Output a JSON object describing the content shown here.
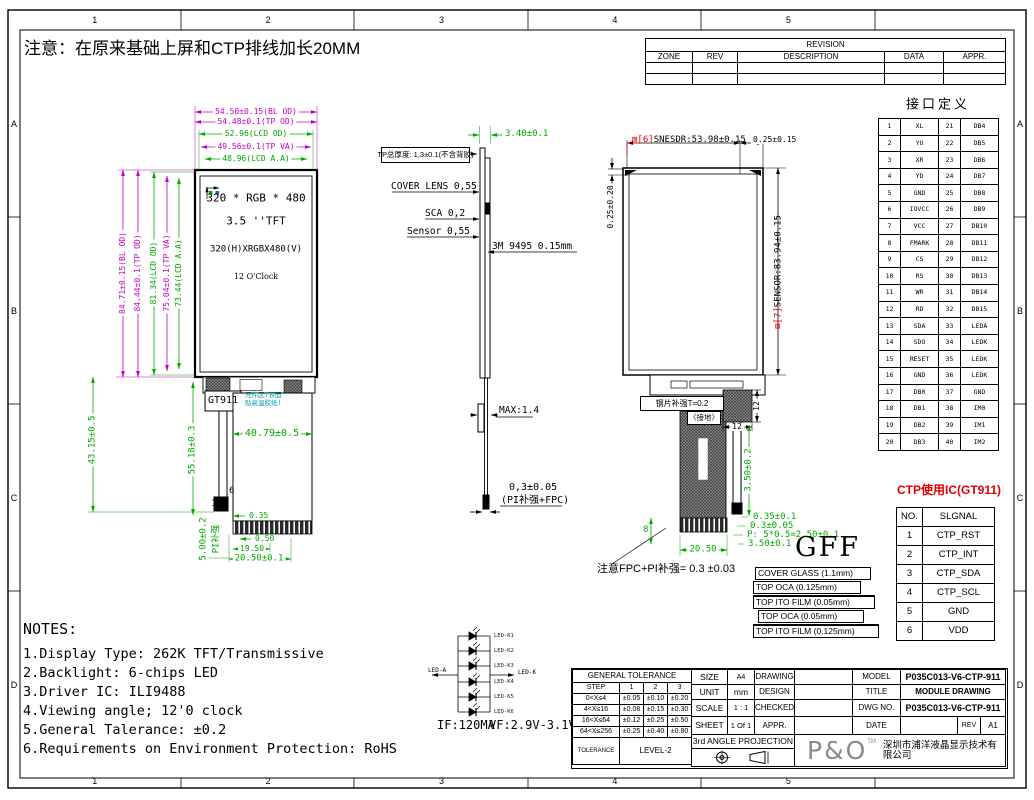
{
  "note_top": "注意：在原来基础上屏和CTP排线加长20MM",
  "border": {
    "cols": [
      "1",
      "2",
      "3",
      "4",
      "5"
    ],
    "rows": [
      "A",
      "B",
      "C",
      "D"
    ]
  },
  "revision": {
    "title": "REVISION",
    "rows": [
      [
        "ZONE",
        "REV",
        "DESCRIPTION",
        "DATA",
        "APPR."
      ],
      [
        "",
        "",
        "",
        "",
        ""
      ],
      [
        "",
        "",
        "",
        "",
        ""
      ]
    ]
  },
  "interface": {
    "title": "接口定义",
    "rows": [
      [
        "1",
        "XL",
        "21",
        "DB4"
      ],
      [
        "2",
        "YU",
        "22",
        "DB5"
      ],
      [
        "3",
        "XR",
        "23",
        "DB6"
      ],
      [
        "4",
        "YD",
        "24",
        "DB7"
      ],
      [
        "5",
        "GND",
        "25",
        "DB8"
      ],
      [
        "6",
        "IOVCC",
        "26",
        "DB9"
      ],
      [
        "7",
        "VCC",
        "27",
        "DB10"
      ],
      [
        "8",
        "FMARK",
        "28",
        "DB11"
      ],
      [
        "9",
        "CS",
        "29",
        "DB12"
      ],
      [
        "10",
        "RS",
        "30",
        "DB13"
      ],
      [
        "11",
        "WR",
        "31",
        "DB14"
      ],
      [
        "12",
        "RD",
        "32",
        "DB15"
      ],
      [
        "13",
        "SDA",
        "33",
        "LEDA"
      ],
      [
        "14",
        "SDO",
        "34",
        "LEDK"
      ],
      [
        "15",
        "RESET",
        "35",
        "LEDK"
      ],
      [
        "16",
        "GND",
        "36",
        "LEDK"
      ],
      [
        "17",
        "DB0",
        "37",
        "GND"
      ],
      [
        "18",
        "DB1",
        "38",
        "IM0"
      ],
      [
        "19",
        "DB2",
        "39",
        "IM1"
      ],
      [
        "20",
        "DB3",
        "40",
        "IM2"
      ]
    ]
  },
  "ctp": {
    "title": "CTP使用IC(GT911)",
    "rows": [
      [
        "NO.",
        "SLGNAL"
      ],
      [
        "1",
        "CTP_RST"
      ],
      [
        "2",
        "CTP_INT"
      ],
      [
        "3",
        "CTP_SDA"
      ],
      [
        "4",
        "CTP_SCL"
      ],
      [
        "5",
        "GND"
      ],
      [
        "6",
        "VDD"
      ]
    ]
  },
  "front": {
    "dims_top": [
      "54.50±0.15(BL OD)",
      "54.48±0.1(TP OD)",
      "52.96(LCD OD)",
      "49.56±0.1(TP VA)",
      "48.96(LCD A.A)"
    ],
    "dims_left": [
      "84.71±0.15(BL OD)",
      "84.44±0.1(TP OD)",
      "81.34(LCD OD)",
      "75.04±0.1(TP VA)",
      "73.44(LCD A.A)"
    ],
    "panel": [
      "320 * RGB * 480",
      "3.5  ''TFT",
      "320(H)XRGBX480(V)",
      "12 O'Clock"
    ],
    "gt911": "GT911",
    "comp_note": "元件区(表面贴高温胶纸)",
    "d4079": "40.79±0.5",
    "d4315": "43.15±0.5",
    "d5518": "55.18±0.3",
    "d500": "5.00±0.2",
    "pi": "PI补强",
    "d035": "0.35",
    "d050": "0.50",
    "d1950": "19.50",
    "d2050": "20.50±0.1",
    "pin6": "6",
    "pin1": "1"
  },
  "side": {
    "d340": "3.40±0.1",
    "tp": "TP总厚度: 1,3±0.1(不含背胶)",
    "cover": "COVER LENS 0,55",
    "sca": "SCA 0,2",
    "sensor": "Sensor 0,55",
    "tape": "3M 9495 0.15mm",
    "max": "MAX:1.4",
    "d03": "0,3±0.05",
    "d03b": "(PI补强+FPC)"
  },
  "sensorview": {
    "top_prefix": "⊠[6]",
    "top_text": "SNESDR:53.98±0.15",
    "d025r": "0.25±0.15",
    "d025l": "0.25±0.20",
    "right_prefix": "⊠[7]",
    "right_text": "SENSOR:83.94±0.15",
    "steel": "钢片补强T=0.2",
    "ground": "〈接地〉",
    "d12v": "12",
    "d12h": "12",
    "d350a": "3.50±0.2",
    "d035": "0.35±0.1",
    "d030": "0.3±0.05",
    "dp": "P: 5*0.5=2.50±0.1",
    "d350b": "3.50±0.1",
    "d2050": "20.50",
    "d8": "8",
    "note": "注意FPC+PI补强= 0.3 ±0.03",
    "gff": "GFF",
    "stack": [
      "COVER GLASS (1.1mm)",
      "TOP OCA (0.125mm)",
      "TOP ITO FILM (0.05mm)",
      "TOP OCA (0.05mm)",
      "TOP ITO FILM (0.125mm)"
    ]
  },
  "notes": {
    "title": "NOTES:",
    "items": [
      "1.Display Type: 262K TFT/Transmissive",
      "2.Backlight: 6-chips LED",
      "3.Driver IC: ILI9488",
      "4.Viewing angle; 12'0 clock",
      "5.General Talerance: ±0.2",
      "6.Requirements on Environment Protection: RoHS"
    ]
  },
  "led": {
    "anode": "LED-A",
    "cathode": "LED-K",
    "labels": [
      "LED-K1",
      "LED-K2",
      "LED-K3",
      "LED-K4",
      "LED-K5",
      "LED-K6"
    ],
    "if_spec": "IF:120MA",
    "vf_spec": "VF:2.9V-3.1V"
  },
  "titleblock": {
    "gt_title": "GENERAL TOLERANCE",
    "gt_rows": [
      [
        "STEP",
        "1",
        "2",
        "3"
      ],
      [
        "0<X≤4",
        "±0.05",
        "±0.10",
        "±0.20"
      ],
      [
        "4<X≤16",
        "±0.08",
        "±0.15",
        "±0.30"
      ],
      [
        "16<X≤64",
        "±0.12",
        "±0.25",
        "±0.50"
      ],
      [
        "64<X≤256",
        "±0.25",
        "±0.40",
        "±0.80"
      ]
    ],
    "tol_label": "TOLERANCE",
    "tol_value": "LEVEL-2",
    "size_l": "SIZE",
    "size_v": "A4",
    "unit_l": "UNIT",
    "unit_v": "mm",
    "scale_l": "SCALE",
    "scale_v": "1 : 1",
    "sheet_l": "SHEET",
    "sheet_v": "1 Of 1",
    "proj": "3rd ANGLE PROJECTION",
    "drawing": "DRAWING",
    "design": "DESIGN",
    "checked": "CHECKED",
    "appr": "APPR.",
    "model_l": "MODEL",
    "model_v": "P035C013-V6-CTP-911",
    "title_l": "TITLE",
    "title_v": "MODULE DRAWING",
    "dwg_l": "DWG NO.",
    "dwg_v": "P035C013-V6-CTP-911",
    "date_l": "DATE",
    "rev_l": "REV",
    "rev_v": "A1",
    "logo": "P&O",
    "tm": "TM",
    "company": "深圳市浦洋液晶显示技术有限公司"
  }
}
